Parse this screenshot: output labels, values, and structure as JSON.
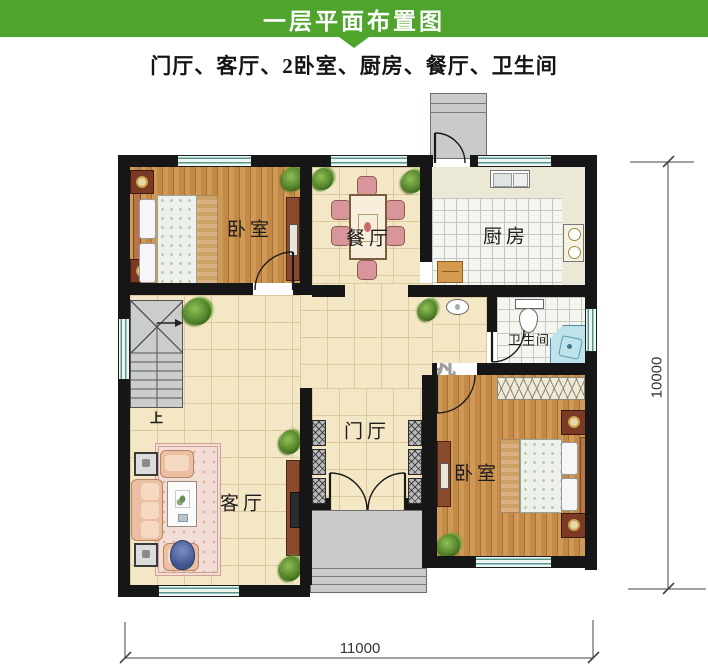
{
  "header": {
    "title": "一层平面布置图",
    "bg_color": "#4fa42d"
  },
  "subtitle": "门厅、客厅、2卧室、厨房、餐厅、卫生间",
  "rooms": {
    "bedroom_top": "卧室",
    "dining": "餐厅",
    "kitchen": "厨房",
    "bathroom": "卫生间",
    "foyer": "门厅",
    "living": "客厅",
    "bedroom_bottom": "卧室",
    "stairs_up": "上"
  },
  "dimensions": {
    "bottom_width": "11000",
    "right_height": "10000"
  },
  "watermark": {
    "name_cn": "鼎川建筑",
    "name_en": "DINGCHUAN JIANZHU"
  },
  "colors": {
    "header_green": "#4fa42d",
    "wall": "#161616",
    "window_teal": "#55978f",
    "wood_floor": "#c8914f",
    "tile_beige": "#f3e7c6",
    "porch_gray": "#c9cbca",
    "shower_blue": "#bfe3ea",
    "watermark_blue": "#7fc3da"
  }
}
